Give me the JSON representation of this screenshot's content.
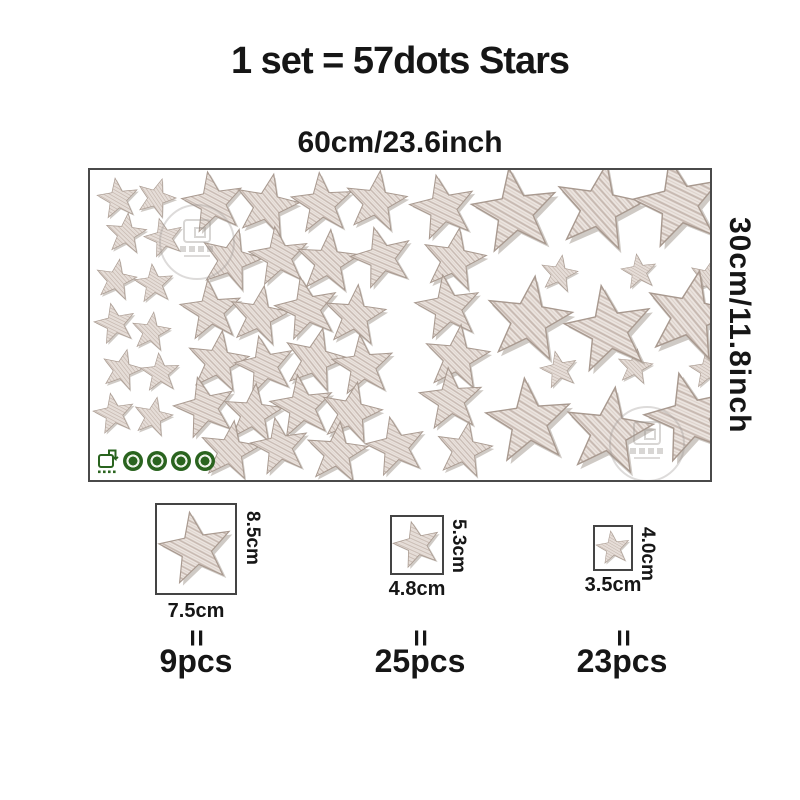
{
  "title": "1 set = 57dots Stars",
  "sheet": {
    "width_label": "60cm/23.6inch",
    "height_label": "30cm/11.8inch",
    "badges": [
      "eco-package-icon",
      "cert-seal-icon",
      "cert-seal-icon",
      "cert-seal-icon",
      "cert-seal-icon"
    ]
  },
  "specs": [
    {
      "height": "8.5cm",
      "width": "7.5cm",
      "equals": "=",
      "count": "9pcs"
    },
    {
      "height": "5.3cm",
      "width": "4.8cm",
      "equals": "=",
      "count": "25pcs"
    },
    {
      "height": "4.0cm",
      "width": "3.5cm",
      "equals": "=",
      "count": "23pcs"
    }
  ],
  "colors": {
    "star_base": "#ece5e0",
    "star_hatch": "#c8bab2",
    "star_hatch_light": "#ddd2cb",
    "star_shade": "#95897f",
    "star_edge": "#a8998f",
    "badge_green": "#2a641f",
    "sheet_border": "#4a4a4a",
    "text": "#161616"
  },
  "stars": {
    "items": [
      {
        "x": 28,
        "y": 29,
        "s": 44,
        "r": -8
      },
      {
        "x": 66,
        "y": 28,
        "s": 42,
        "r": 18
      },
      {
        "x": 36,
        "y": 64,
        "s": 44,
        "r": 6
      },
      {
        "x": 74,
        "y": 68,
        "s": 42,
        "r": -14
      },
      {
        "x": 26,
        "y": 110,
        "s": 44,
        "r": 10
      },
      {
        "x": 64,
        "y": 114,
        "s": 42,
        "r": -6
      },
      {
        "x": 25,
        "y": 154,
        "s": 44,
        "r": -12
      },
      {
        "x": 61,
        "y": 162,
        "s": 42,
        "r": 8
      },
      {
        "x": 32,
        "y": 200,
        "s": 44,
        "r": 14
      },
      {
        "x": 70,
        "y": 203,
        "s": 42,
        "r": -4
      },
      {
        "x": 24,
        "y": 244,
        "s": 44,
        "r": -10
      },
      {
        "x": 63,
        "y": 247,
        "s": 42,
        "r": 12
      },
      {
        "x": 123,
        "y": 33,
        "s": 66,
        "r": -10
      },
      {
        "x": 177,
        "y": 36,
        "s": 68,
        "r": 12
      },
      {
        "x": 232,
        "y": 34,
        "s": 66,
        "r": -5
      },
      {
        "x": 286,
        "y": 32,
        "s": 66,
        "r": 8
      },
      {
        "x": 353,
        "y": 38,
        "s": 70,
        "r": -12
      },
      {
        "x": 141,
        "y": 90,
        "s": 66,
        "r": 15
      },
      {
        "x": 189,
        "y": 87,
        "s": 64,
        "r": -8
      },
      {
        "x": 238,
        "y": 92,
        "s": 68,
        "r": 5
      },
      {
        "x": 292,
        "y": 88,
        "s": 66,
        "r": -15
      },
      {
        "x": 364,
        "y": 90,
        "s": 68,
        "r": 10
      },
      {
        "x": 121,
        "y": 141,
        "s": 66,
        "r": -6
      },
      {
        "x": 169,
        "y": 146,
        "s": 64,
        "r": 10
      },
      {
        "x": 217,
        "y": 139,
        "s": 68,
        "r": -12
      },
      {
        "x": 265,
        "y": 146,
        "s": 66,
        "r": 6
      },
      {
        "x": 358,
        "y": 138,
        "s": 70,
        "r": -9
      },
      {
        "x": 128,
        "y": 192,
        "s": 66,
        "r": 8
      },
      {
        "x": 175,
        "y": 196,
        "s": 64,
        "r": -12
      },
      {
        "x": 225,
        "y": 190,
        "s": 68,
        "r": 14
      },
      {
        "x": 273,
        "y": 196,
        "s": 66,
        "r": -6
      },
      {
        "x": 367,
        "y": 188,
        "s": 70,
        "r": 7
      },
      {
        "x": 115,
        "y": 238,
        "s": 66,
        "r": -14
      },
      {
        "x": 163,
        "y": 244,
        "s": 64,
        "r": 6
      },
      {
        "x": 212,
        "y": 237,
        "s": 68,
        "r": -8
      },
      {
        "x": 261,
        "y": 243,
        "s": 66,
        "r": 12
      },
      {
        "x": 361,
        "y": 230,
        "s": 68,
        "r": -5
      },
      {
        "x": 140,
        "y": 281,
        "s": 64,
        "r": 8
      },
      {
        "x": 190,
        "y": 277,
        "s": 62,
        "r": -10
      },
      {
        "x": 247,
        "y": 283,
        "s": 66,
        "r": 6
      },
      {
        "x": 306,
        "y": 277,
        "s": 64,
        "r": -12
      },
      {
        "x": 374,
        "y": 280,
        "s": 60,
        "r": 10
      },
      {
        "x": 469,
        "y": 104,
        "s": 40,
        "r": 10
      },
      {
        "x": 549,
        "y": 102,
        "s": 38,
        "r": -8
      },
      {
        "x": 618,
        "y": 108,
        "s": 40,
        "r": 14
      },
      {
        "x": 469,
        "y": 200,
        "s": 40,
        "r": -12
      },
      {
        "x": 545,
        "y": 197,
        "s": 38,
        "r": 8
      },
      {
        "x": 618,
        "y": 200,
        "s": 40,
        "r": -6
      },
      {
        "x": 425,
        "y": 42,
        "s": 92,
        "r": -8
      },
      {
        "x": 509,
        "y": 38,
        "s": 94,
        "r": 10
      },
      {
        "x": 589,
        "y": 34,
        "s": 96,
        "r": -12
      },
      {
        "x": 439,
        "y": 150,
        "s": 92,
        "r": 8
      },
      {
        "x": 519,
        "y": 160,
        "s": 94,
        "r": -10
      },
      {
        "x": 600,
        "y": 146,
        "s": 96,
        "r": 12
      },
      {
        "x": 439,
        "y": 252,
        "s": 92,
        "r": -6
      },
      {
        "x": 519,
        "y": 262,
        "s": 94,
        "r": 8
      },
      {
        "x": 600,
        "y": 248,
        "s": 96,
        "r": -14
      }
    ]
  }
}
